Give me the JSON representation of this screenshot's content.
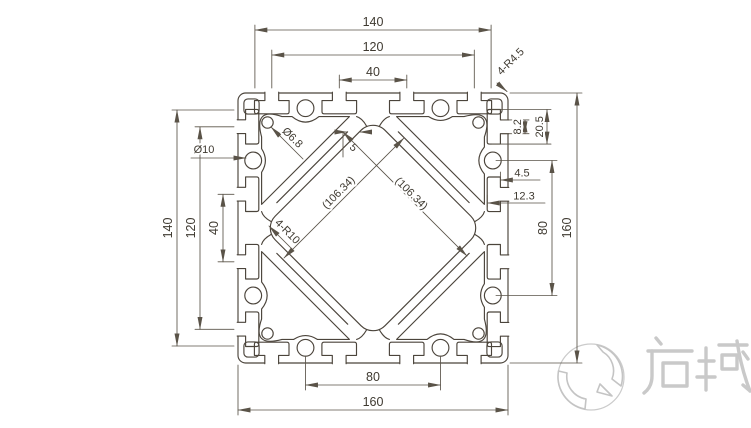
{
  "drawing": {
    "title": "aluminium-profile-160x160-section",
    "dims": {
      "top_140": "140",
      "top_120": "120",
      "top_40": "40",
      "corner_fillet": "4-R4.5",
      "slot_opening": "8.2",
      "slot_cavity": "20.5",
      "slot_lip_depth": "4.5",
      "slot_depth": "12.3",
      "right_80": "80",
      "right_160": "160",
      "left_140": "140",
      "left_120": "120",
      "left_40": "40",
      "hole_dia": "Ø10",
      "corner_hole_dia": "Ø6.8",
      "center_radius": "4-R10",
      "wall_thickness": "5",
      "diag_left": "(106.34)",
      "diag_right": "(106.34)",
      "bottom_80": "80",
      "bottom_160": "160"
    },
    "logo": {
      "text": "启域"
    },
    "colors": {
      "line": "#4b443b",
      "dimline": "#5a5348",
      "logo_gray": "#c6c6c6",
      "background": "#ffffff"
    }
  }
}
